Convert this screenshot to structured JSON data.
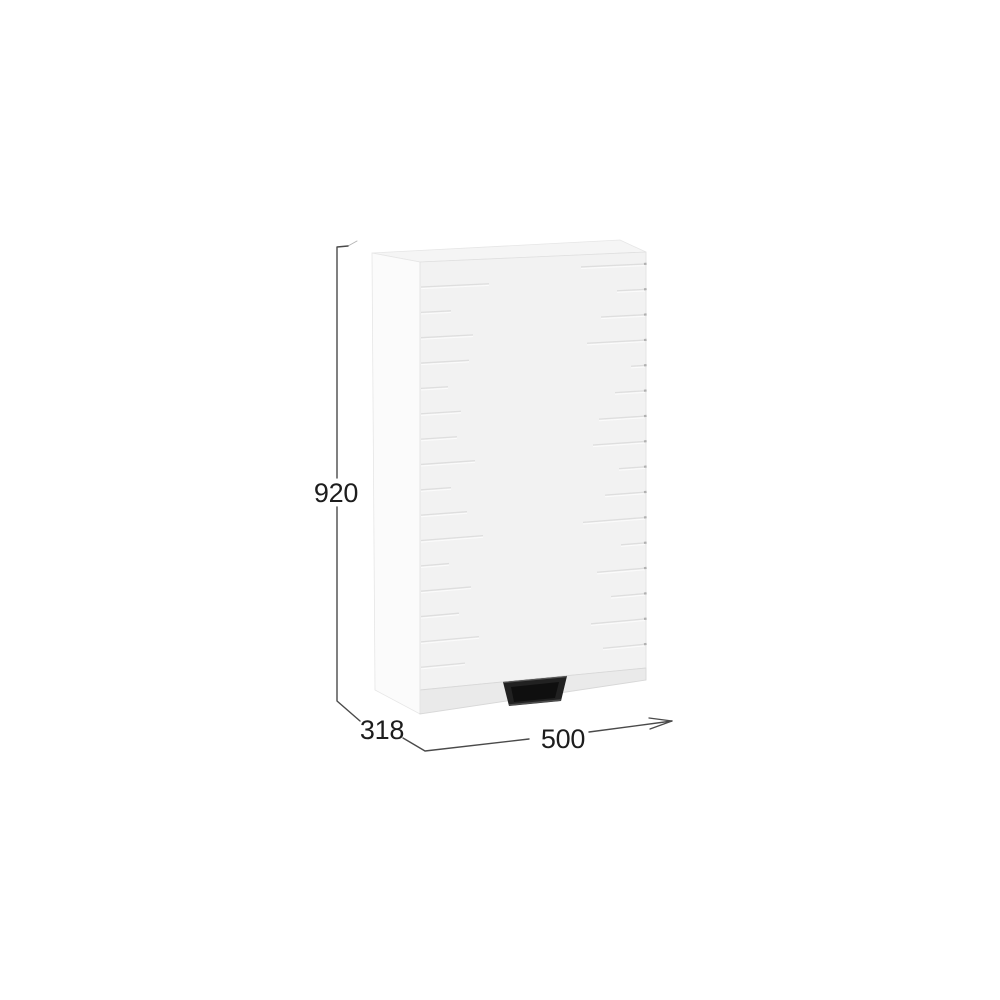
{
  "diagram": {
    "kind": "furniture-dimension-drawing",
    "subject": "wall-cabinet-with-profile-handle",
    "dimensions": {
      "height": "920",
      "depth": "318",
      "width": "500"
    },
    "colors": {
      "background": "#ffffff",
      "dimension_line": "#4a4a4a",
      "dimension_tick_faint": "#b5b5b5",
      "dimension_text": "#1d1d1d",
      "top_face": "#f5f5f5",
      "side_panel": "#fbfbfb",
      "door_face": "#f2f2f2",
      "bottom_face": "#eaeaea",
      "groove": "#dcdcdc",
      "groove_highlight": "#fdfdfd",
      "groove_tick": "#a8a8a8",
      "handle_outer": "#212121",
      "handle_inner": "#0f0f0f",
      "handle_lip": "#4d4d4d"
    },
    "grooves": {
      "spacing": 25.35,
      "left_start_offset": 25,
      "right_start_offset": 12,
      "left_lengths": [
        68,
        30,
        52,
        48,
        27,
        40,
        36,
        54,
        30,
        46,
        62,
        28,
        50,
        38,
        58,
        44
      ],
      "right_lengths": [
        64,
        28,
        44,
        58,
        14,
        30,
        46,
        52,
        26,
        40,
        62,
        24,
        48,
        34,
        54,
        42
      ]
    }
  }
}
